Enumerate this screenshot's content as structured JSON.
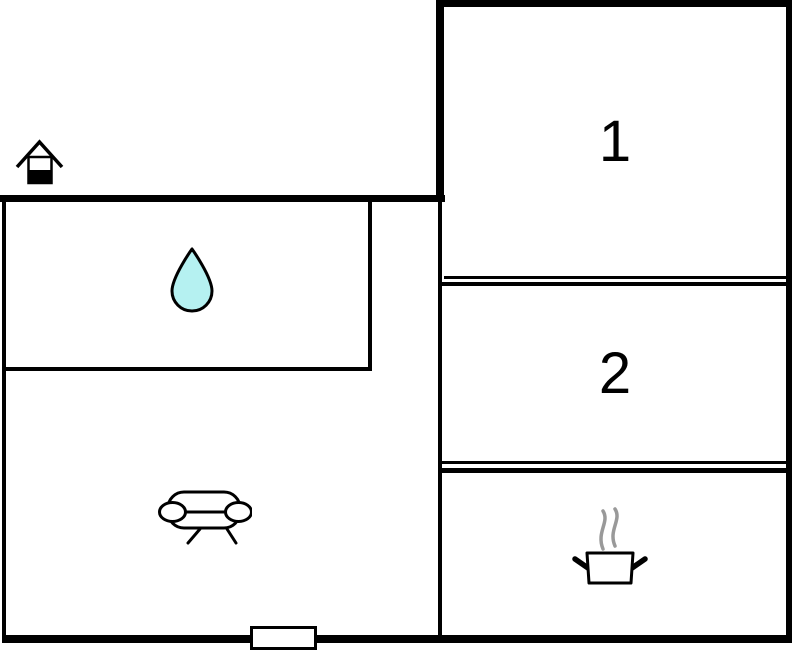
{
  "colors": {
    "wall": "#000000",
    "background": "#ffffff",
    "water_drop_fill": "#b5f1f1",
    "water_drop_stroke": "#000000",
    "steam": "#999999"
  },
  "rooms": {
    "room1": {
      "label": "1"
    },
    "room2": {
      "label": "2"
    }
  },
  "icons": [
    {
      "name": "entrance-house-icon",
      "meaning": "entrance"
    },
    {
      "name": "water-drop-icon",
      "meaning": "bathroom / water"
    },
    {
      "name": "sofa-icon",
      "meaning": "living room"
    },
    {
      "name": "cooking-pot-icon",
      "meaning": "kitchen"
    },
    {
      "name": "door-opening",
      "meaning": "entrance door in bottom wall"
    }
  ]
}
